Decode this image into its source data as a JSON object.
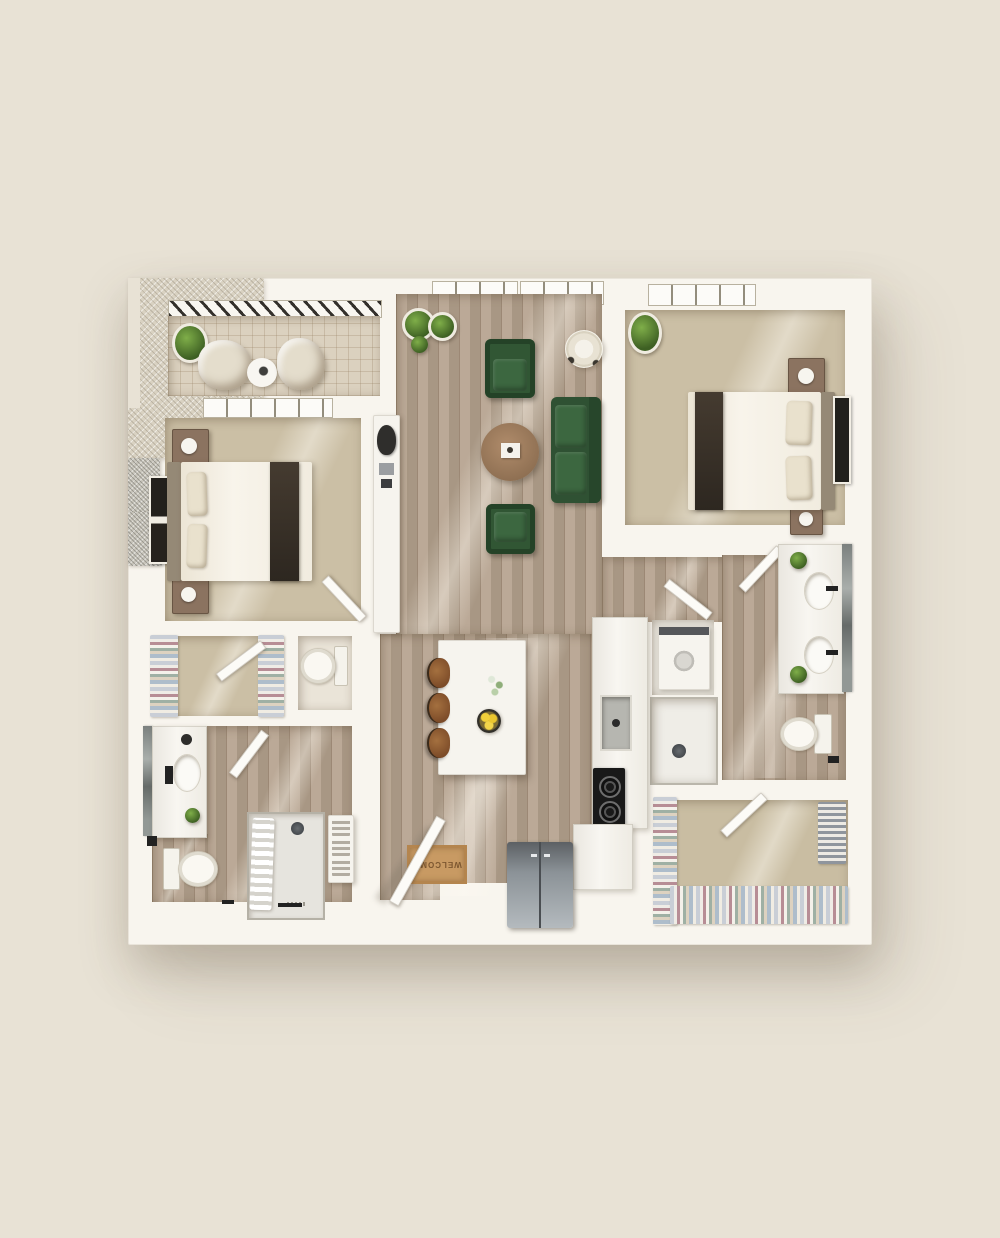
{
  "scene": {
    "type": "floor-plan-3d-top-view",
    "description": "Photorealistic top-down 3D rendering of a two-bedroom, two-bathroom apartment with balcony, open living area, galley kitchen and two walk-in closets"
  },
  "entry": {
    "mat_text": "WELCOME"
  },
  "palette": {
    "background": "#e8e2d5",
    "wall": "#f8f5ee",
    "wood_floor": "#b5a28e",
    "carpet": "#cbbfa5",
    "balcony_tile": "#dbd1bf",
    "area_rug": "#d9d2c2",
    "upholstery_green": "#2f5233",
    "coffee_table_wood": "#a5866a",
    "island_white": "#f7f5f0",
    "stool_leather": "#8d5a34",
    "doormat_tan": "#c89a63",
    "appliance_steel": "#9aa1a6",
    "cooktop_black": "#191919"
  },
  "rooms": [
    {
      "name": "balcony",
      "items": [
        "potted-plant",
        "lounge-chair",
        "round-side-table",
        "lounge-chair"
      ]
    },
    {
      "name": "bedroom-1",
      "items": [
        "queen-bed",
        "nightstand-with-lamp",
        "nightstand-with-lamp",
        "wall-art",
        "built-in-desk",
        "desk-chair"
      ]
    },
    {
      "name": "living-room",
      "items": [
        "area-rug",
        "green-armchair",
        "green-armchair",
        "green-sofa",
        "round-coffee-table",
        "potted-plants",
        "accent-chair"
      ]
    },
    {
      "name": "bedroom-2",
      "items": [
        "queen-bed",
        "nightstand-with-lamp",
        "nightstand-with-lamp",
        "wall-art",
        "potted-plant"
      ]
    },
    {
      "name": "bathroom-2",
      "items": [
        "double-vanity",
        "mirror",
        "toilet",
        "bath-mat",
        "walk-in-shower"
      ]
    },
    {
      "name": "laundry-closet",
      "items": [
        "washer"
      ]
    },
    {
      "name": "walk-in-closet-2",
      "items": [
        "hanging-clothes-rack",
        "hanging-clothes-rack",
        "hanging-clothes-rack"
      ]
    },
    {
      "name": "kitchen",
      "items": [
        "island",
        "bar-stool",
        "bar-stool",
        "bar-stool",
        "sink",
        "cooktop",
        "counter",
        "refrigerator",
        "bowl-of-lemons",
        "flower-stems"
      ]
    },
    {
      "name": "walk-in-closet-1",
      "items": [
        "hanging-clothes-rack",
        "hanging-clothes-rack"
      ]
    },
    {
      "name": "water-closet",
      "items": [
        "toilet"
      ]
    },
    {
      "name": "bathroom-1",
      "items": [
        "vanity",
        "mirror",
        "toilet",
        "bath-mat",
        "walk-in-shower",
        "towels",
        "linen-shelves"
      ]
    },
    {
      "name": "entry",
      "items": [
        "entry-door",
        "welcome-mat"
      ]
    }
  ]
}
